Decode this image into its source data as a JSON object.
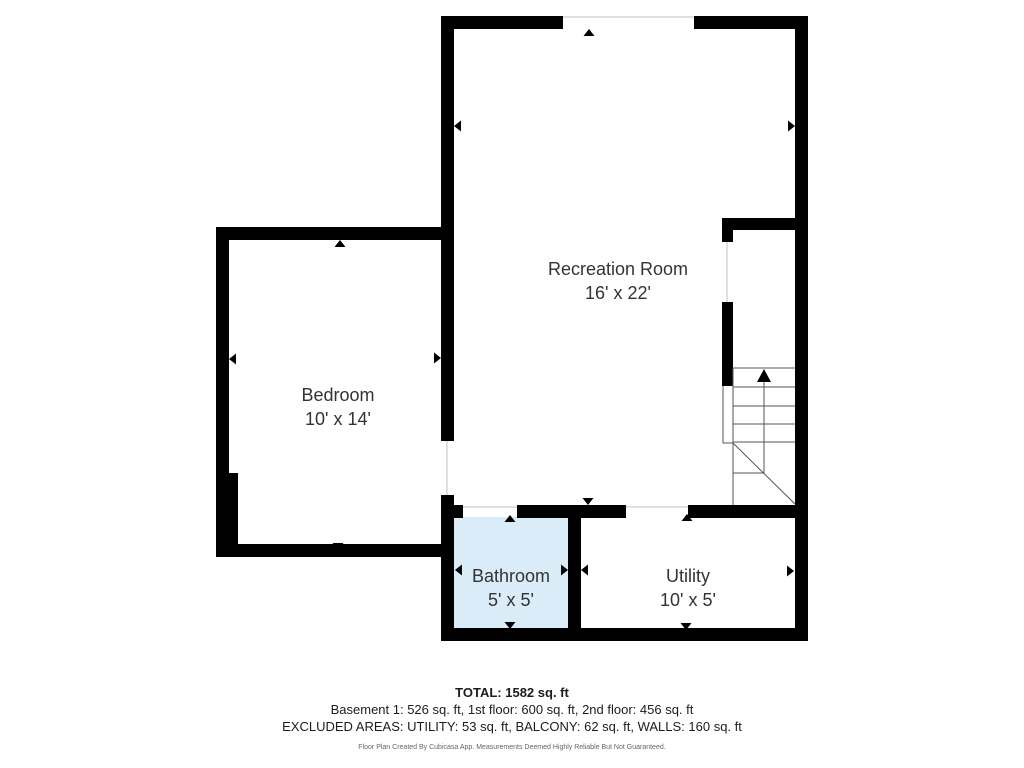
{
  "colors": {
    "wall": "#000000",
    "bathroom_fill": "#daecf7",
    "stair_line": "#555555",
    "opening_line": "#d6d6d6",
    "label_text": "#333333",
    "summary_text": "#1c1c1c",
    "fine_print": "#666666"
  },
  "rooms": [
    {
      "name": "Recreation Room",
      "dims": "16' x 22'"
    },
    {
      "name": "Bedroom",
      "dims": "10' x 14'"
    },
    {
      "name": "Bathroom",
      "dims": "5' x 5'"
    },
    {
      "name": "Utility",
      "dims": "10' x 5'"
    }
  ],
  "summary": {
    "total": "TOTAL: 1582 sq. ft",
    "floors": "Basement 1: 526 sq. ft, 1st floor: 600 sq. ft, 2nd floor: 456 sq. ft",
    "excluded": "EXCLUDED AREAS: UTILITY: 53 sq. ft, BALCONY: 62 sq. ft, WALLS: 160 sq. ft",
    "disclaimer": "Floor Plan Created By Cubicasa App. Measurements Deemed Highly Reliable But Not Guaranteed."
  }
}
